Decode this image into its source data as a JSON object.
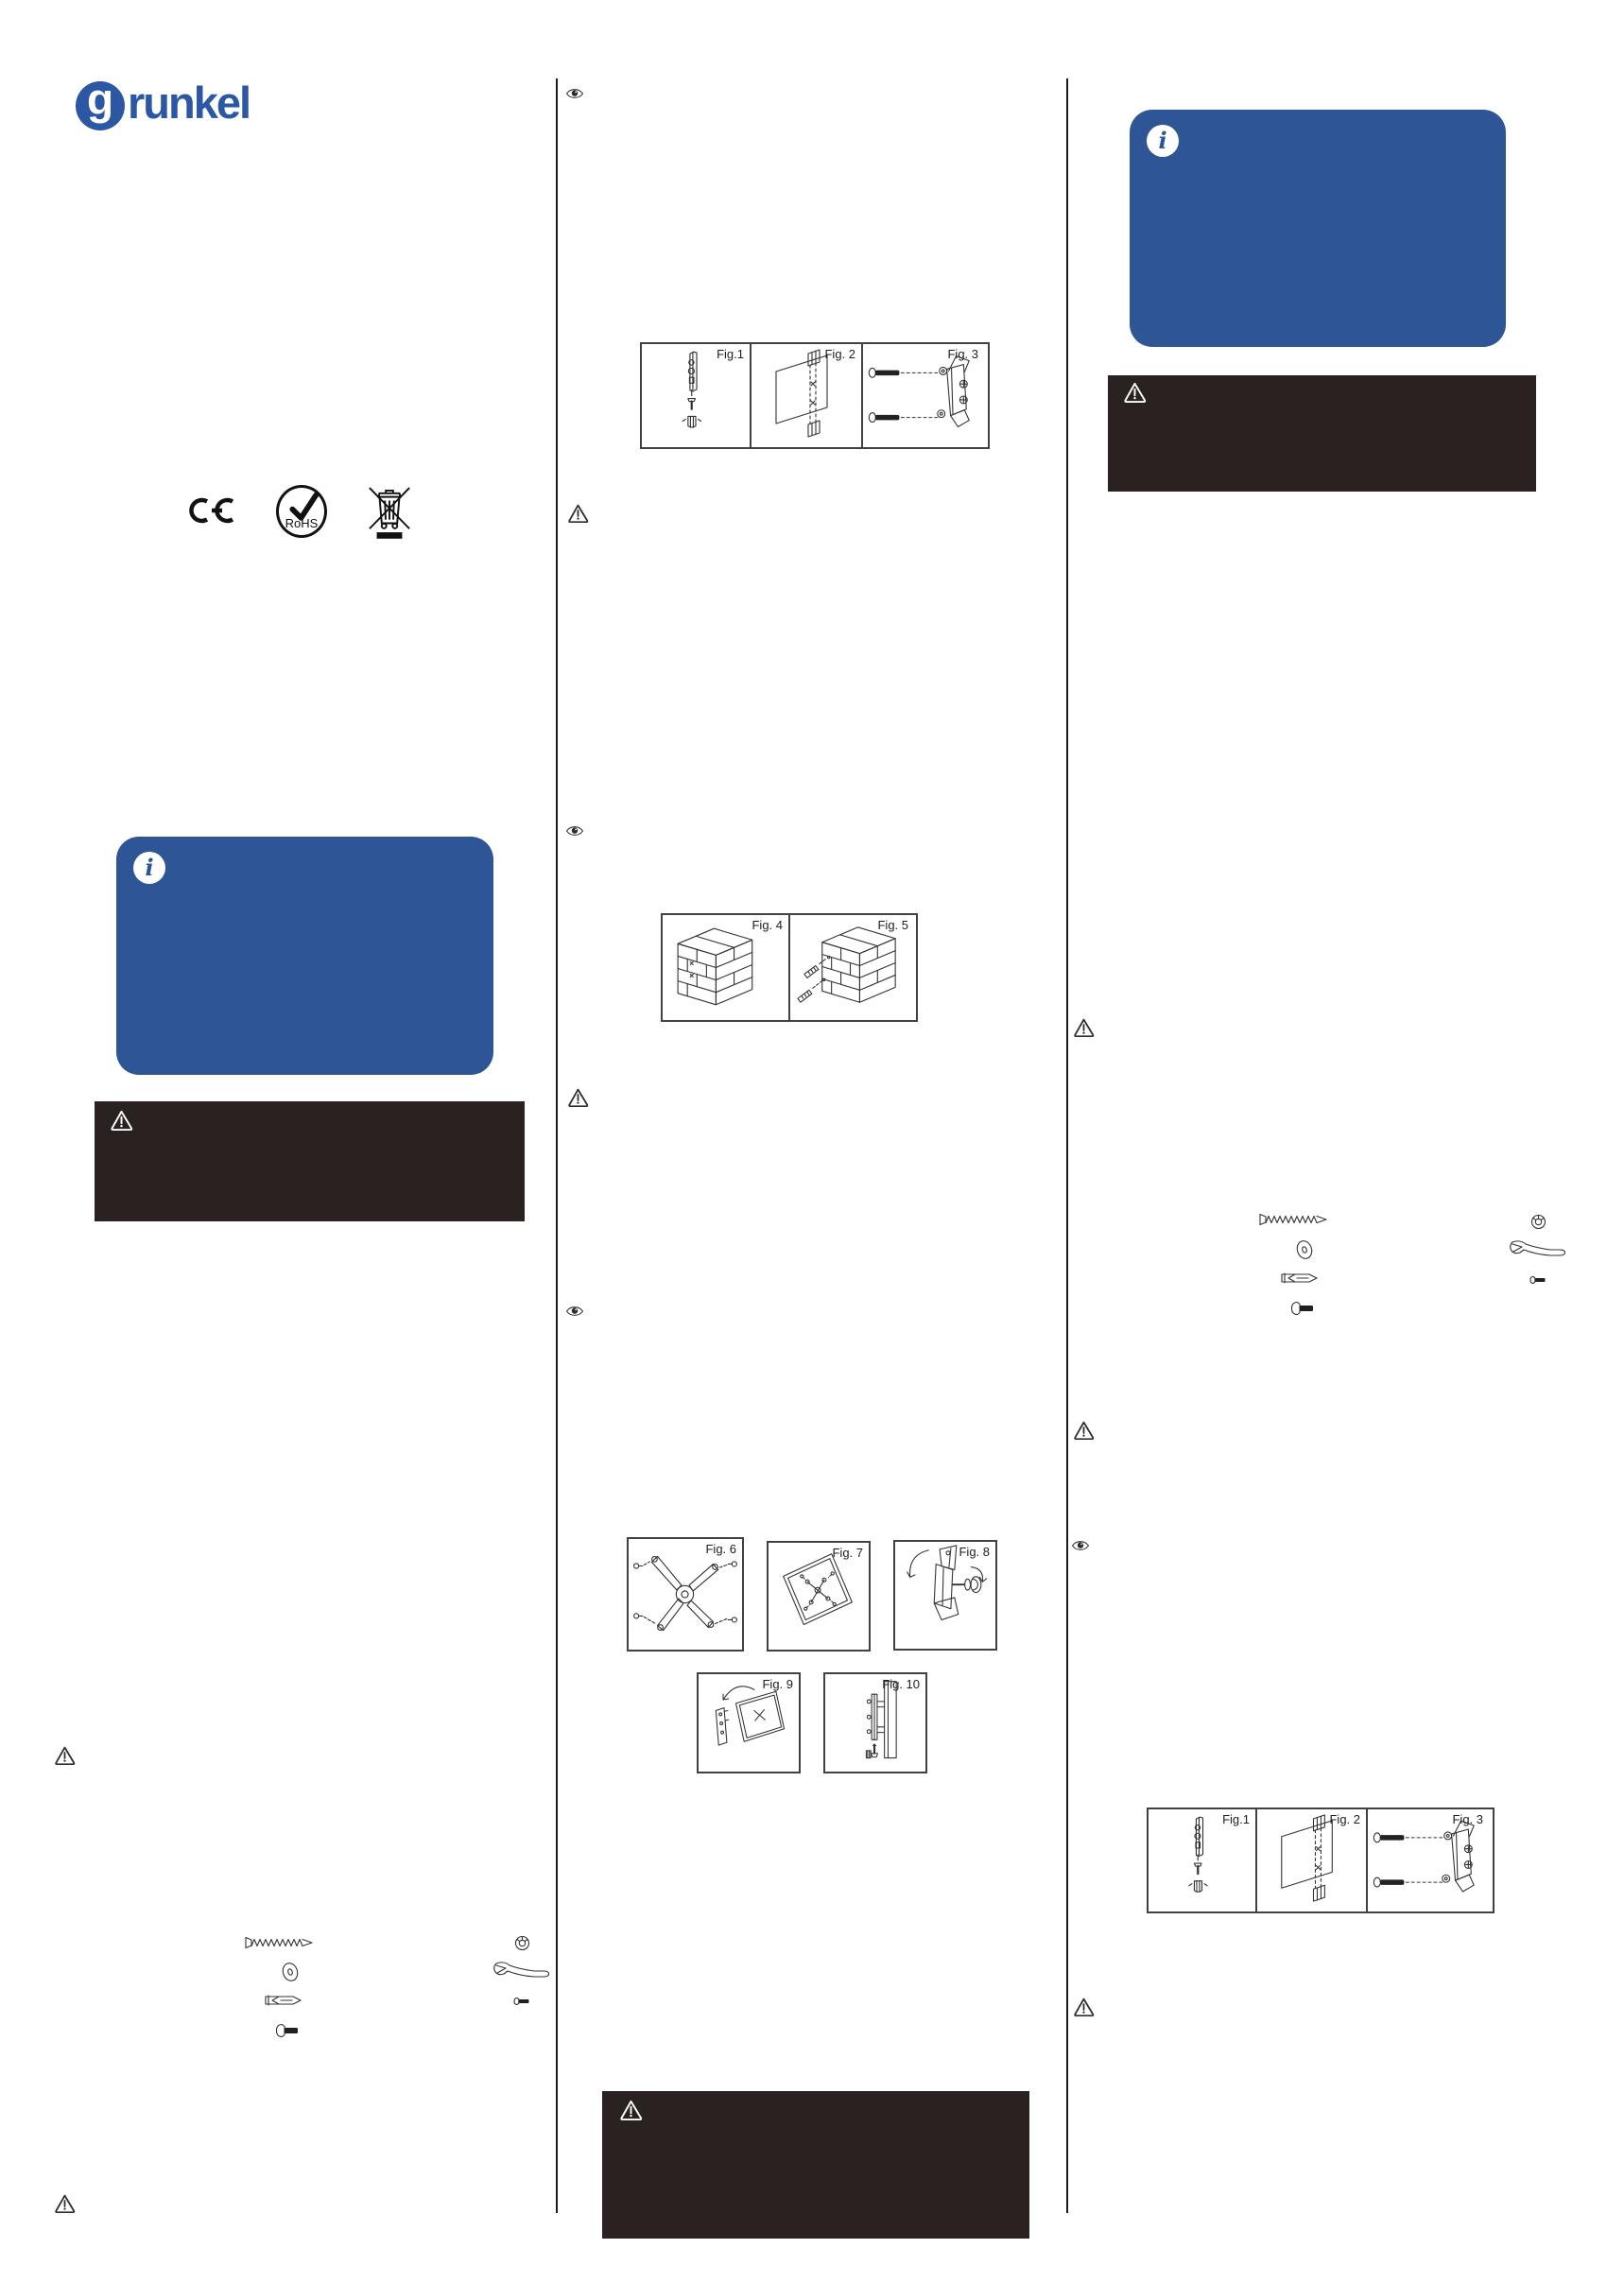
{
  "logo": {
    "g_letter": "g",
    "wordmark": "runkel"
  },
  "certifications": {
    "ce_label": "CE",
    "rohs_label": "RoHS"
  },
  "icons": {
    "info_glyph": "i",
    "info": "info-icon",
    "warning": "warning-triangle-icon",
    "eye": "eye-icon",
    "ce": "ce-mark-icon",
    "rohs": "rohs-check-icon",
    "weee": "weee-crossed-bin-icon",
    "hardware": [
      "long-screw-icon",
      "washer-icon",
      "wall-anchor-icon",
      "bolt-icon",
      "nut-icon",
      "wrench-icon",
      "small-bolt-icon"
    ]
  },
  "colors": {
    "brand_blue": "#2b57a5",
    "info_box_blue": "#2e5596",
    "warning_box_black": "#292220",
    "line_art": "#333333"
  },
  "figures": {
    "set1": [
      "Fig.1",
      "Fig. 2",
      "Fig. 3"
    ],
    "set2": [
      "Fig. 4",
      "Fig. 5"
    ],
    "set3": [
      "Fig. 6",
      "Fig. 7",
      "Fig. 8"
    ],
    "set4": [
      "Fig. 9",
      "Fig. 10"
    ],
    "set5": [
      "Fig.1",
      "Fig. 2",
      "Fig. 3"
    ]
  }
}
